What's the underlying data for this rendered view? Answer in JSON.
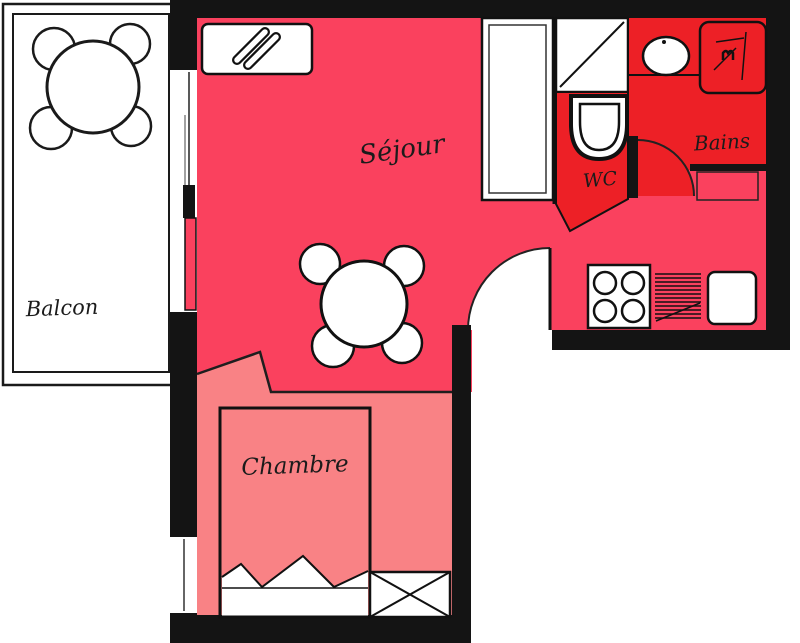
{
  "plan": {
    "type": "apartment-floor-plan",
    "rooms": {
      "balcon": {
        "label": "Balcon"
      },
      "sejour": {
        "label": "Séjour"
      },
      "chambre": {
        "label": "Chambre"
      },
      "wc": {
        "label": "WC"
      },
      "bains": {
        "label": "Bains"
      }
    },
    "colors": {
      "sejour": "#fa415e",
      "wet": "#ed2026",
      "chambre": "#f98285",
      "wall": "#141414",
      "paper": "#ffffff"
    }
  }
}
